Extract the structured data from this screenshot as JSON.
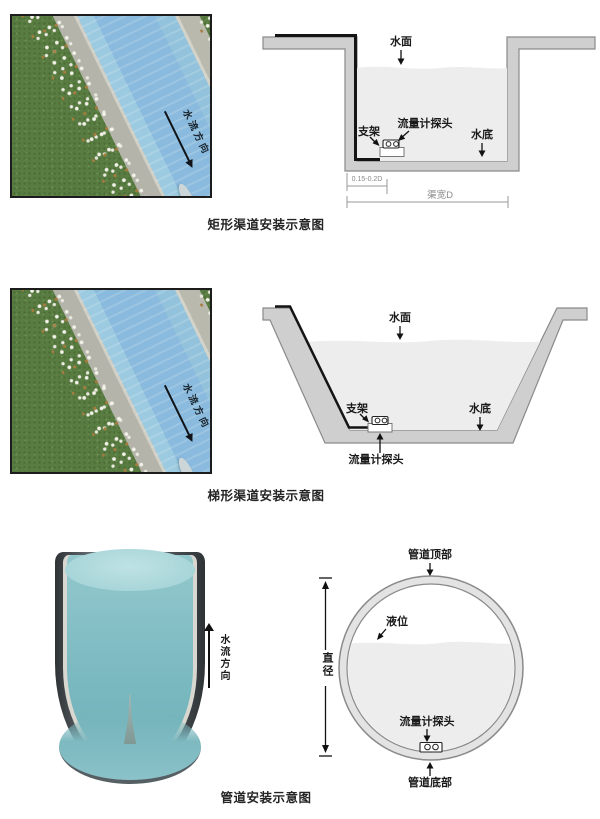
{
  "sections": [
    {
      "caption": "矩形渠道安装示意图",
      "photo": {
        "flow_label": "水流方向"
      },
      "labels": {
        "water_surface": "水面",
        "probe": "流量计探头",
        "bracket": "支架",
        "water_bottom": "水底",
        "dim_offset": "0.15-0.2D",
        "dim_width": "渠宽D"
      }
    },
    {
      "caption": "梯形渠道安装示意图",
      "photo": {
        "flow_label": "水流方向"
      },
      "labels": {
        "water_surface": "水面",
        "bracket": "支架",
        "water_bottom": "水底",
        "probe": "流量计探头"
      }
    },
    {
      "caption": "管道安装示意图",
      "pipe": {
        "flow_label": "水流方向"
      },
      "labels": {
        "pipe_top": "管道顶部",
        "level": "液位",
        "diameter": "直径",
        "probe": "流量计探头",
        "pipe_bottom": "管道底部"
      }
    }
  ],
  "colors": {
    "diagram_wall": "#cfcfcf",
    "diagram_wall_stroke": "#8a8a8a",
    "diagram_water": "#ededed",
    "cable": "#141414",
    "photo_water": "#8cbfdc",
    "photo_grass": "#587c41",
    "photo_concrete": "#b6b6ad",
    "pipe_water_teal": "#7cbac1",
    "label_text": "#1a1a1a"
  }
}
